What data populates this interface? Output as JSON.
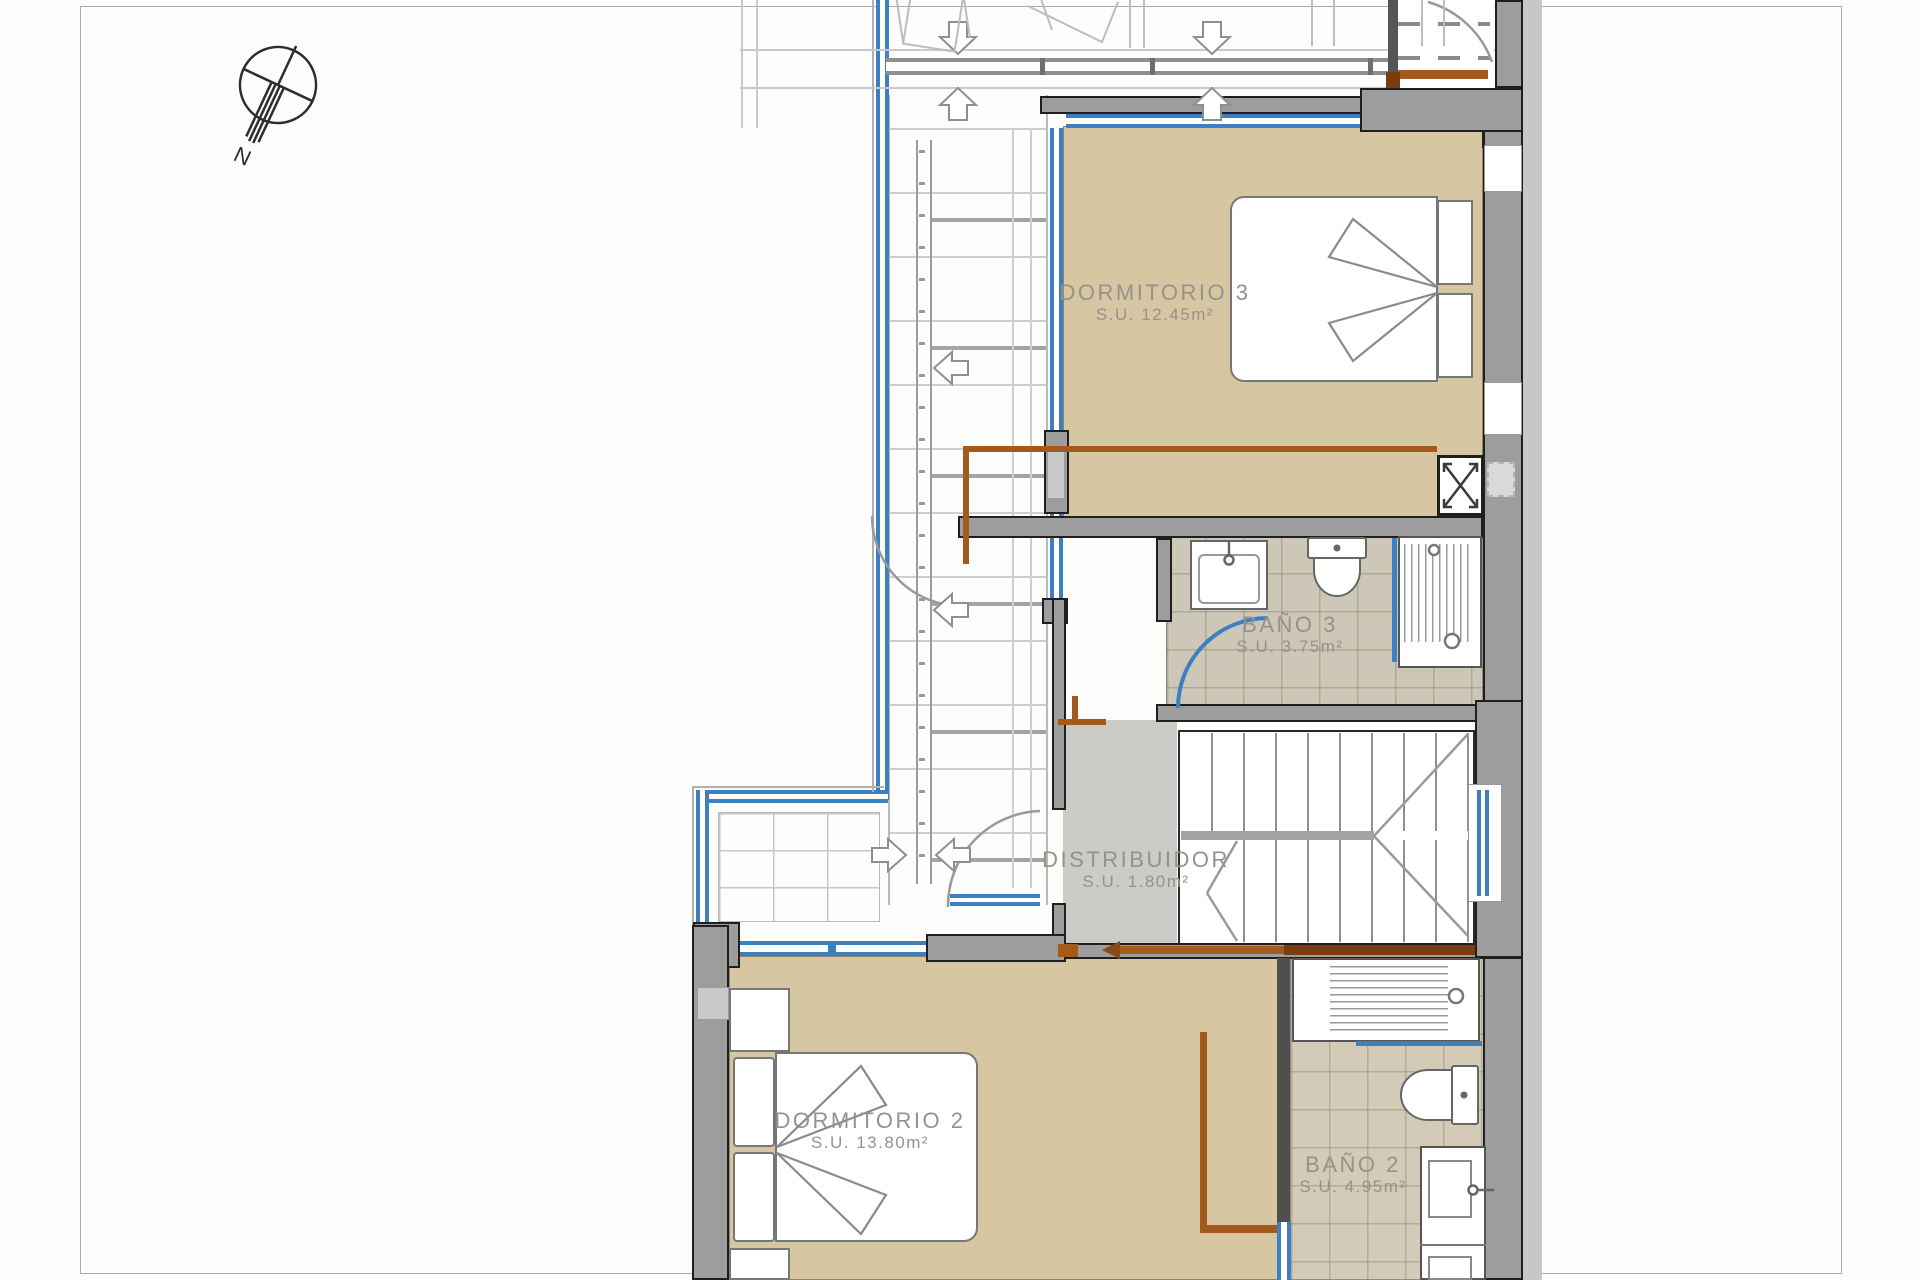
{
  "title": "floor-plan",
  "compass": {
    "label": "N"
  },
  "rooms": [
    {
      "id": "dormitorio-3",
      "name": "DORMITORIO 3",
      "area": "S.U. 12.45m²"
    },
    {
      "id": "bano-3",
      "name": "BAÑO 3",
      "area": "S.U. 3.75m²"
    },
    {
      "id": "distribuidor",
      "name": "DISTRIBUIDOR",
      "area": "S.U. 1.80m²"
    },
    {
      "id": "dormitorio-2",
      "name": "DORMITORIO 2",
      "area": "S.U. 13.80m²"
    },
    {
      "id": "bano-2",
      "name": "BAÑO 2",
      "area": "S.U. 4.95m²"
    }
  ],
  "colors": {
    "room_floor_tan": "#d6c7a2",
    "bath_tile": "#cdc7b8",
    "hall_floor": "#cbcbc7",
    "wall_gray": "#9d9d9d",
    "glazing_blue": "#3c80c2",
    "pipe_brown": "#a4591d",
    "label_text": "#96918a"
  }
}
